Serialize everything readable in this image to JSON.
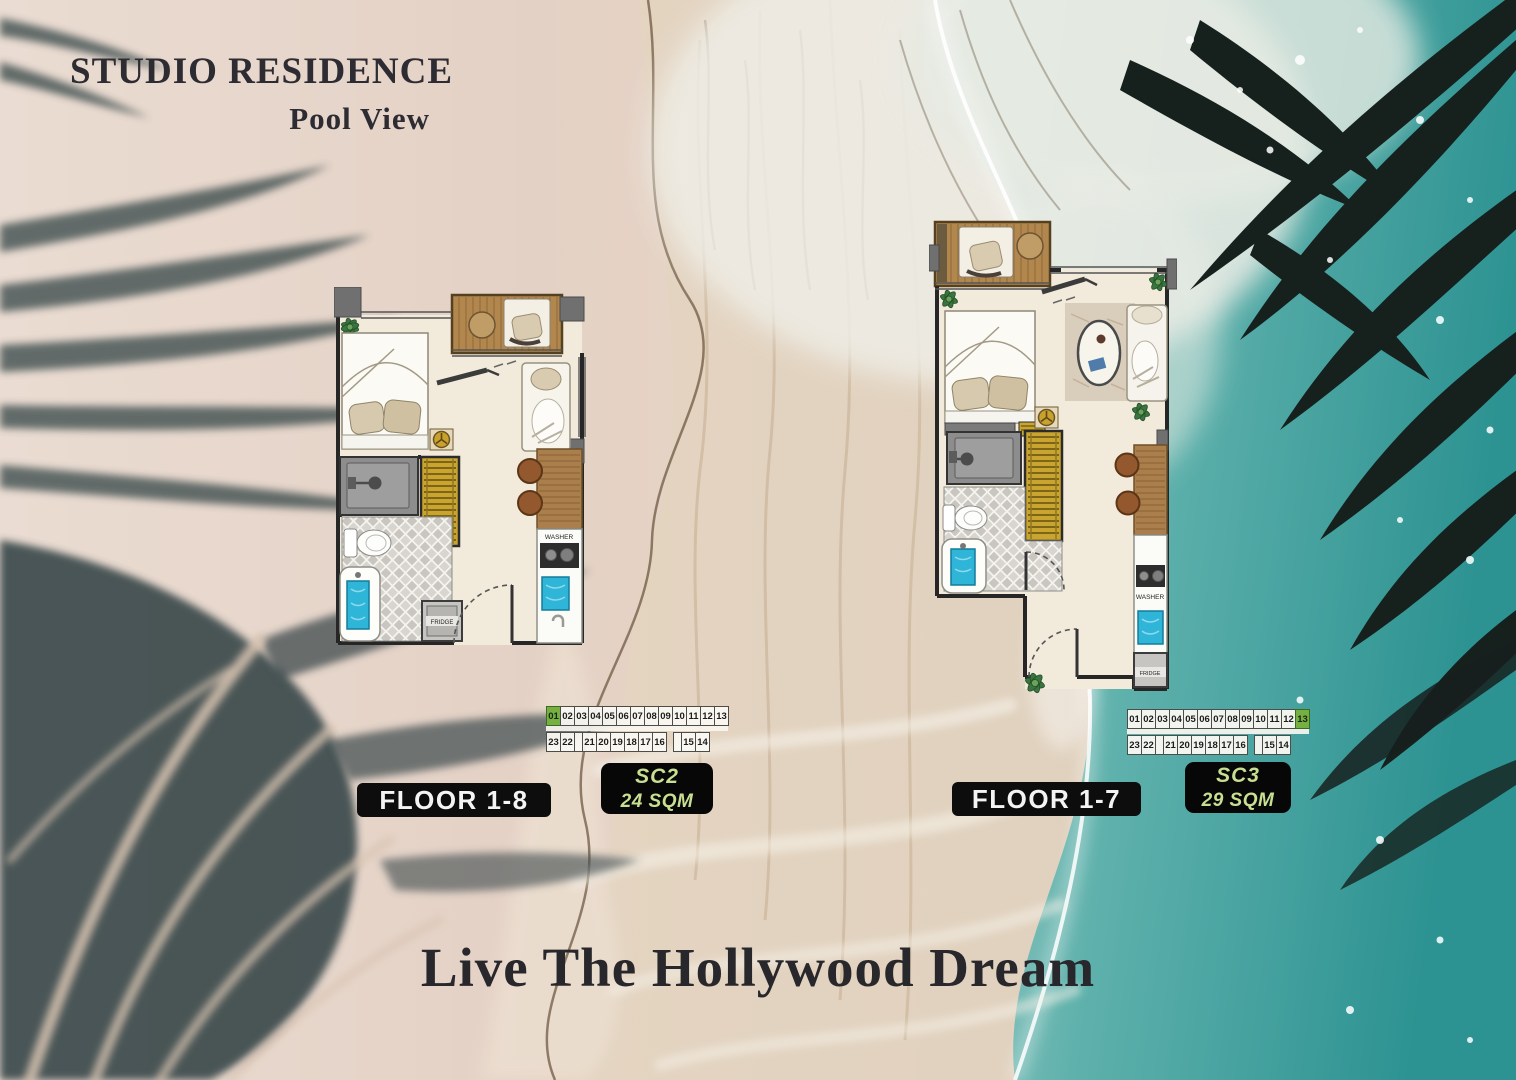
{
  "header": {
    "title": "STUDIO RESIDENCE",
    "subtitle": "Pool View"
  },
  "tagline": "Live The Hollywood Dream",
  "plan_labels": {
    "washer": "WASHER",
    "fridge": "FRIDGE"
  },
  "colors": {
    "accent_green": "#76b043",
    "badge_text": "#c8df92",
    "pill_bg": "#0d0d0d",
    "water": "#2e9493",
    "sand": "#e4d2c6"
  },
  "units": [
    {
      "unit_code": "SC2",
      "area": "24 SQM",
      "floor_label": "FLOOR 1-8",
      "strip_top": [
        {
          "label": "01",
          "highlight": true
        },
        {
          "label": "02"
        },
        {
          "label": "03"
        },
        {
          "label": "04"
        },
        {
          "label": "05"
        },
        {
          "label": "06"
        },
        {
          "label": "07"
        },
        {
          "label": "08"
        },
        {
          "label": "09"
        },
        {
          "label": "10"
        },
        {
          "label": "11"
        },
        {
          "label": "12"
        },
        {
          "label": "13"
        }
      ],
      "strip_bottom": [
        {
          "label": "23"
        },
        {
          "label": "22"
        },
        {
          "label": "",
          "gapbox": true
        },
        {
          "label": "21"
        },
        {
          "label": "20"
        },
        {
          "label": "19"
        },
        {
          "label": "18"
        },
        {
          "label": "17"
        },
        {
          "label": "16"
        },
        {
          "label": "",
          "spacer": true
        },
        {
          "label": "",
          "gapbox": true
        },
        {
          "label": "15"
        },
        {
          "label": "14"
        }
      ]
    },
    {
      "unit_code": "SC3",
      "area": "29 SQM",
      "floor_label": "FLOOR 1-7",
      "strip_top": [
        {
          "label": "01"
        },
        {
          "label": "02"
        },
        {
          "label": "03"
        },
        {
          "label": "04"
        },
        {
          "label": "05"
        },
        {
          "label": "06"
        },
        {
          "label": "07"
        },
        {
          "label": "08"
        },
        {
          "label": "09"
        },
        {
          "label": "10"
        },
        {
          "label": "11"
        },
        {
          "label": "12"
        },
        {
          "label": "13",
          "highlight": true
        }
      ],
      "strip_bottom": [
        {
          "label": "23"
        },
        {
          "label": "22"
        },
        {
          "label": "",
          "gapbox": true
        },
        {
          "label": "21"
        },
        {
          "label": "20"
        },
        {
          "label": "19"
        },
        {
          "label": "18"
        },
        {
          "label": "17"
        },
        {
          "label": "16"
        },
        {
          "label": "",
          "spacer": true
        },
        {
          "label": "",
          "gapbox": true
        },
        {
          "label": "15"
        },
        {
          "label": "14"
        }
      ]
    }
  ]
}
